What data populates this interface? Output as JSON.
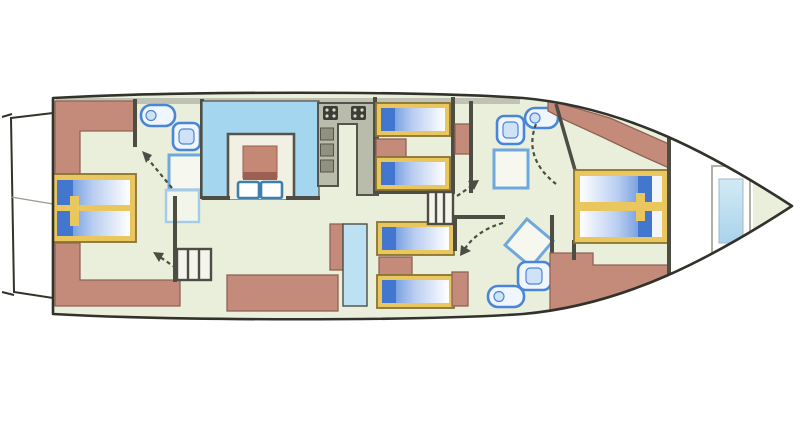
{
  "canvas": {
    "width": 800,
    "height": 446
  },
  "diagram": {
    "type": "yacht-deck-plan",
    "orientation": "bow-right-stern-left"
  },
  "colors": {
    "hull_fill": "#eaefdc",
    "hull_stroke": "#32322b",
    "wall": "#4d4d44",
    "wall_shadow": "#b2b4a5",
    "furniture_salmon": "#c48b7a",
    "furniture_salmon_dark": "#8f6355",
    "bed_frame": "#e9c75e",
    "bed_frame_stroke": "#8a7433",
    "pillow_blue": "#4377cf",
    "mattress_blue": "#7aa3e2",
    "mattress_mid": "#b9cdf0",
    "mattress_white": "#ffffff",
    "dinette_blue": "#a5d6f0",
    "window_blue": "#bce1f3",
    "fixture_blue": "#4a86d8",
    "fixture_fill": "#f0f6fd",
    "fixture_inner": "#cfe2f7",
    "shower_blue": "#6fa8dc",
    "shower_blue_light": "#a6cbe8",
    "galley_gray": "#b9bcab",
    "galley_dark": "#54544c",
    "stove_dark": "#3d3d37",
    "table_salmon": "#c58874",
    "table_salmon_dark": "#9c5f52",
    "stairs_fill": "#f4f4ec",
    "platform_white": "#ffffff",
    "bow_white": "#ffffff",
    "window_inner_top": "#d3eaf6",
    "window_inner_bottom": "#a9d3ea"
  },
  "inventory": {
    "cabins": 4,
    "berths": 8,
    "double_beds": 2,
    "single_bunks": 4,
    "bathrooms": 3,
    "toilets": 3,
    "sinks": 3,
    "shower_trays": 4,
    "staircases": 2,
    "dinette_tables": 1,
    "dinette_chairs": 2,
    "galley_burner_units": 2,
    "swim_platforms": 1,
    "bow_hatches": 1
  },
  "icons": {
    "toilet": "blue-outlined-pill",
    "sink": "blue-outlined-rounded-square",
    "shower": "light-blue-outlined-square",
    "stove": "dark-square-with-dots",
    "stairs": "barred-rectangle",
    "door_swing": "dashed-arrow"
  }
}
